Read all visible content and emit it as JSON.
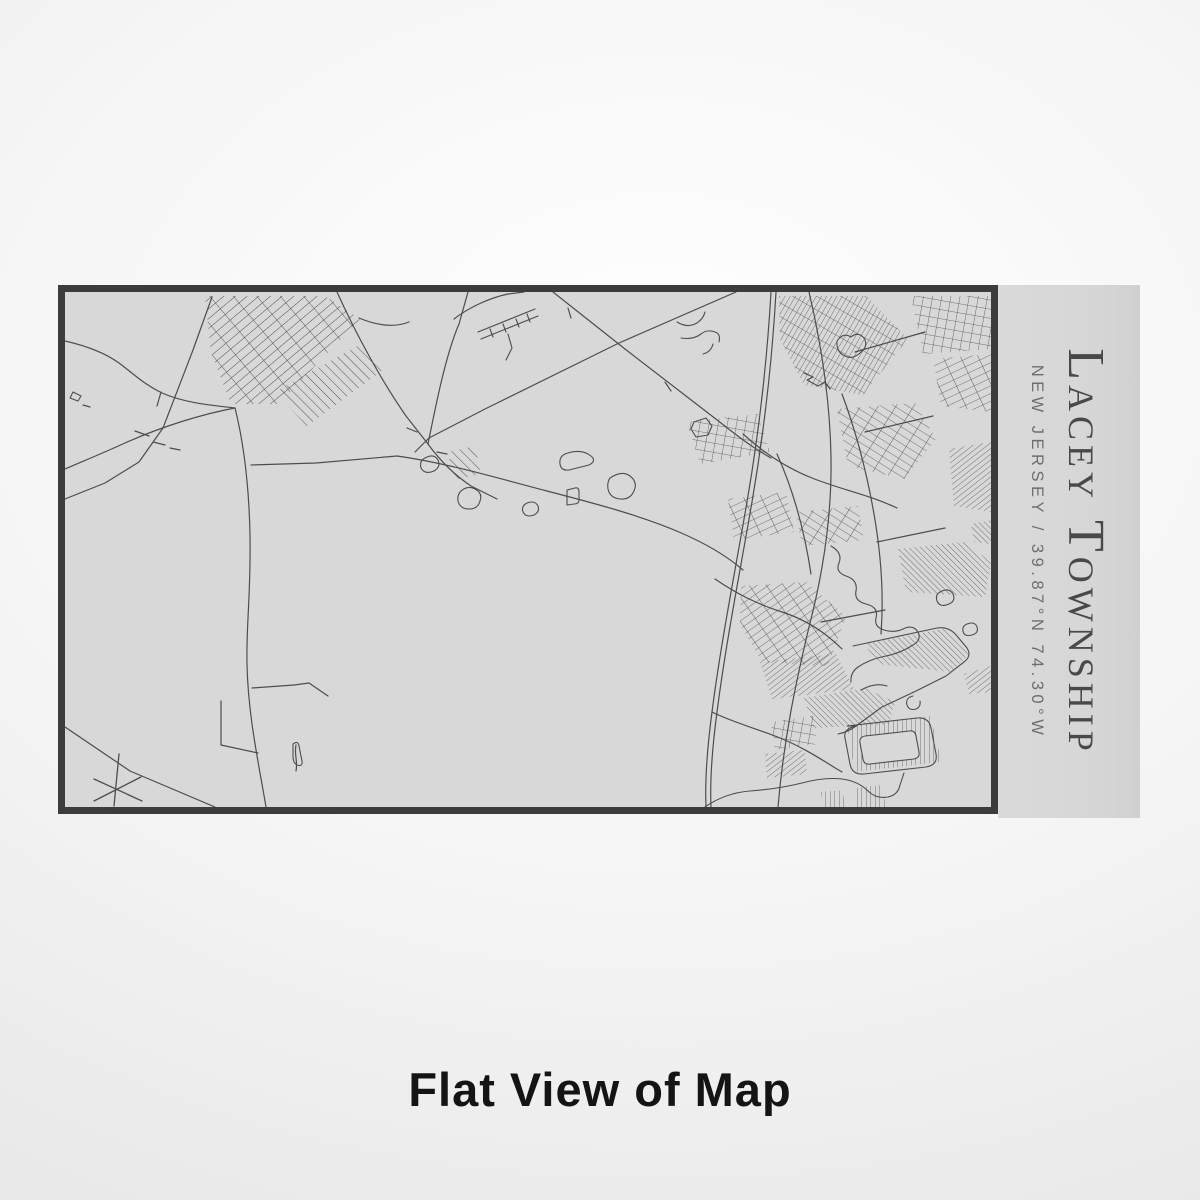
{
  "plaque": {
    "title": "Lacey Township",
    "subtitle": "NEW JERSEY / 39.87°N 74.30°W"
  },
  "caption": {
    "text": "Flat View of Map"
  },
  "colors": {
    "page_background_center": "#ffffff",
    "page_background_edge": "#e2e2e2",
    "map_fill": "#d8d8d8",
    "map_border": "#3a3c3e",
    "map_line": "#4b4d4f",
    "plaque_fill": "#d8d8d8",
    "title_text": "#47494b",
    "subtitle_text": "#6b6e70",
    "caption_text": "#141414"
  }
}
